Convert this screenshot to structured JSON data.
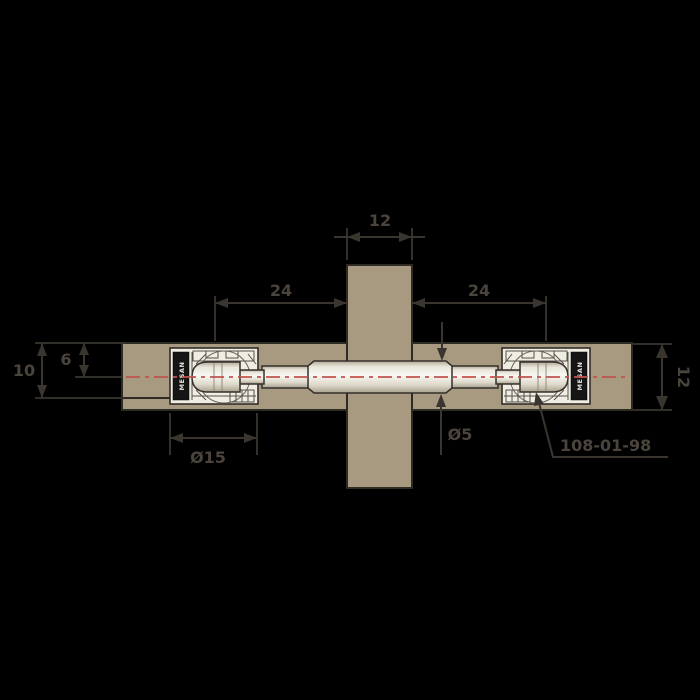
{
  "drawing": {
    "type": "technical-cross-section",
    "subject": "concealed cabinet connector fitting joining a shelf panel to a partition panel"
  },
  "brand": {
    "label": "MESAN"
  },
  "part": {
    "number": "108-01-98"
  },
  "dims": {
    "partition_width": "12",
    "left_drill_distance": "24",
    "right_drill_distance": "24",
    "drill_depth": "10",
    "axis_offset": "6",
    "panel_thickness": "12",
    "housing_diameter": "Ø15",
    "shaft_diameter": "Ø5"
  },
  "colors": {
    "background": "#000000",
    "panel": "#a79a81",
    "panel_outline": "#2e2a24",
    "fitting_body": "#f0ede3",
    "shaft_highlight": "#f8f7f2",
    "dimension_lines": "#3a352f",
    "dimension_text": "#4a443c",
    "centerline": "#c0544c",
    "brand_strip": "#151515",
    "brand_text": "#e4e4e0"
  }
}
